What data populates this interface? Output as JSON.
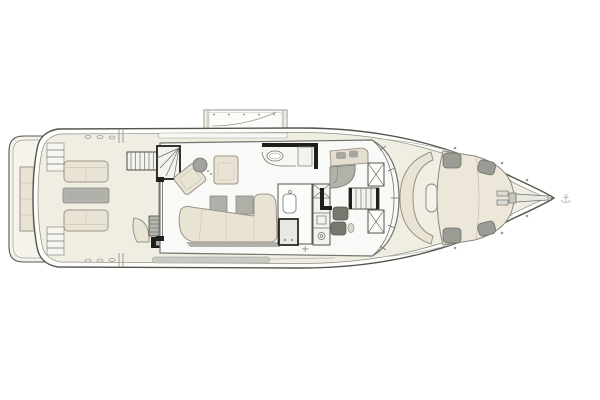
{
  "diagram": {
    "type": "yacht-main-deck-floor-plan",
    "orientation": "bow-right",
    "regions": [
      "swim-platform",
      "transom-sunpad",
      "cockpit-lounge",
      "flybridge-stairs",
      "salon",
      "galley",
      "day-head",
      "helm-station",
      "companionway-stairs",
      "fold-down-terrace",
      "foredeck-settee",
      "bow-sunpad",
      "anchor-gear"
    ]
  },
  "symbols": {
    "anchor_glyph": "⚓",
    "deck_cross": "+"
  },
  "colors": {
    "background": "#ffffff",
    "outline": "#55544f",
    "outline_dark": "#1e1e1c",
    "deck": "#f0ede2",
    "cabin_floor": "#f9f9f7",
    "cushion": "#e9e3d3",
    "cushion_border": "#9a9488",
    "table_gray": "#b0b0aa",
    "dark_gray": "#78786f",
    "mid_gray": "#c9c9c3",
    "stair_fill": "#f4f2ec",
    "pad_gray": "#9c9c96"
  }
}
